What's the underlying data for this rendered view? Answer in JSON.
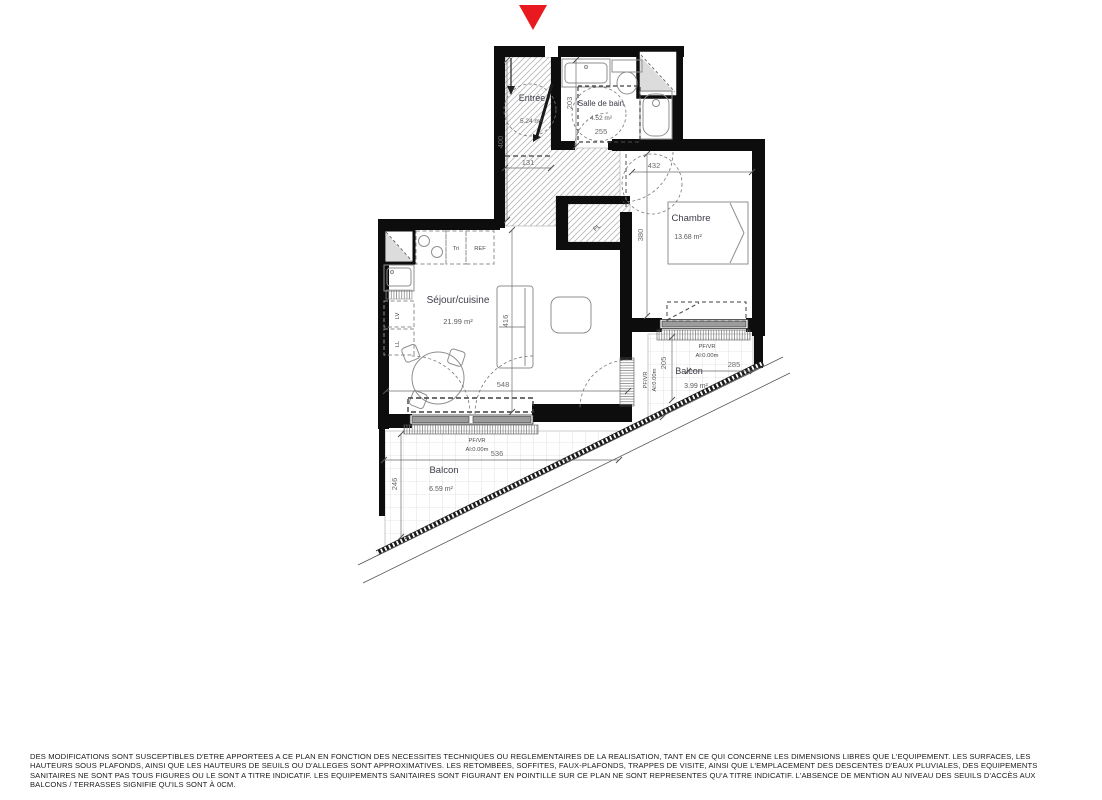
{
  "marker": {
    "color": "#e8191f"
  },
  "plan": {
    "rooms": {
      "entree": {
        "name": "Entrée",
        "area": "5.24 m²"
      },
      "sdb": {
        "name": "Salle de bain",
        "area": "4.52 m²"
      },
      "chambre": {
        "name": "Chambre",
        "area": "13.68 m²"
      },
      "sejour": {
        "name": "Séjour/cuisine",
        "area": "21.99 m²"
      },
      "balcon1": {
        "name": "Balcon",
        "area": "3.99 m²"
      },
      "balcon2": {
        "name": "Balcon",
        "area": "6.59 m²"
      }
    },
    "dims": {
      "d400": "400",
      "d131": "131",
      "d203": "203",
      "d255": "255",
      "d432": "432",
      "d380": "380",
      "d416": "416",
      "d548": "548",
      "d205": "205",
      "d285": "285",
      "d536": "536",
      "d246": "246"
    },
    "labels": {
      "tri": "Tri",
      "ref": "REF",
      "lv": "LV",
      "ll": "LL",
      "pl": "PL",
      "pfvr": "PF/VR",
      "al": "Al:0.00m"
    }
  },
  "footer": {
    "lines": [
      "DES MODIFICATIONS SONT SUSCEPTIBLES D'ETRE APPORTEES A CE PLAN EN FONCTION DES NECESSITES TECHNIQUES OU REGLEMENTAIRES DE LA REALISATION, TANT EN CE QUI CONCERNE LES DIMENSIONS LIBRES QUE L'EQUIPEMENT. LES SURFACES, LES",
      "HAUTEURS SOUS PLAFONDS, AINSI QUE LES HAUTEURS DE SEUILS OU D'ALLEGES SONT APPROXIMATIVES. LES RETOMBEES, SOFFITES, FAUX-PLAFONDS, TRAPPES DE VISITE, AINSI QUE L'EMPLACEMENT DES DESCENTES D'EAUX PLUVIALES, DES EQUIPEMENTS",
      "SANITAIRES NE SONT PAS TOUS FIGURES OU LE SONT A TITRE INDICATIF. LES EQUIPEMENTS SANITAIRES SONT FIGURANT EN POINTILLE SUR CE PLAN NE SONT REPRESENTES QU'A TITRE INDICATIF. L'ABSENCE DE MENTION AU NIVEAU DES SEUILS D'ACCÈS AUX",
      "BALCONS / TERRASSES SIGNIFIE QU'ILS SONT À 0CM."
    ]
  }
}
